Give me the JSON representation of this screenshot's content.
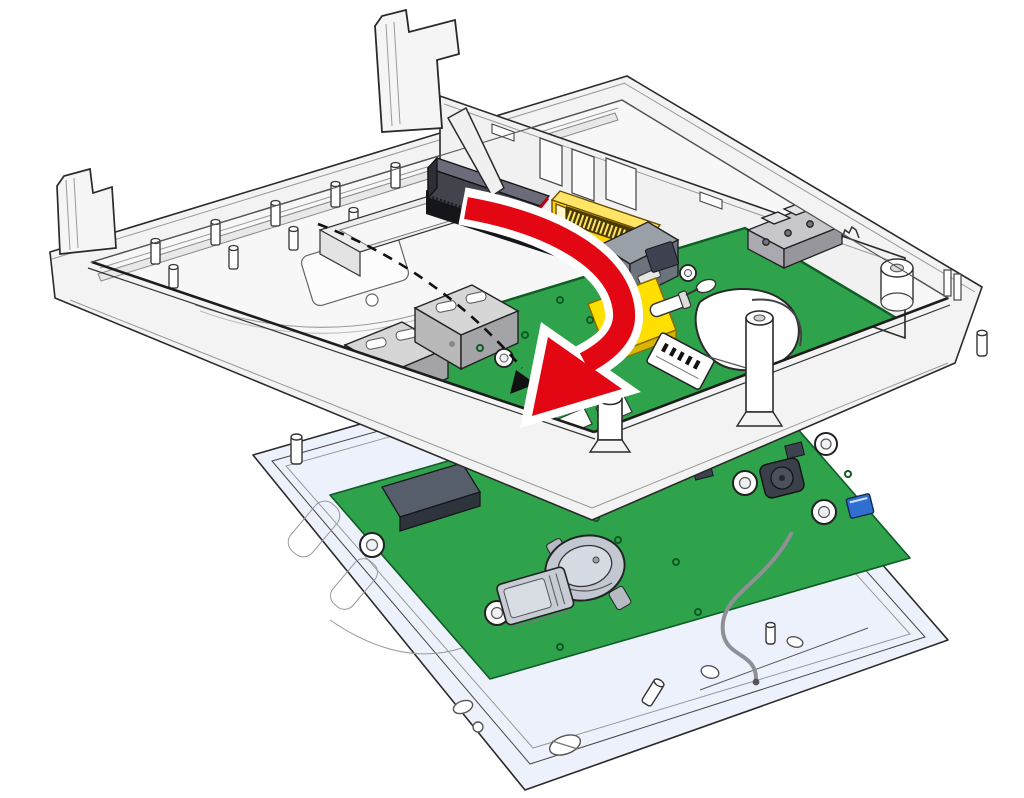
{
  "figure_type": "exploded-assembly-illustration",
  "colors": {
    "background": "#ffffff",
    "outline": "#2a2a2a",
    "case_fill": "#f3f3f3",
    "case_floor": "#f7f7f7",
    "tray_fill": "#edf1fb",
    "tray_inner": "#e6ebf9",
    "pcb_green": "#2fa24c",
    "pcb_green_dark": "#0f5c26",
    "arrow_red": "#e30613",
    "arrow_outline": "#ffffff",
    "connector_yellow": "#ffd200",
    "connector_yellow_light": "#ffe465",
    "pad_yellow": "#ffdf00",
    "connector_dark": "#43434e",
    "metal_gray": "#c9ccd3",
    "metal_gray_dark": "#9aa0aa",
    "component_blue": "#2f6fd0",
    "guide_dash": "#111111"
  },
  "parts": [
    {
      "name": "rear-housing",
      "desc": "white enclosure shell, open side up"
    },
    {
      "name": "housing-clip-large",
      "desc": "snap tab on rear edge"
    },
    {
      "name": "housing-clip-small",
      "desc": "snap tab on left corner"
    },
    {
      "name": "inner-bracket",
      "desc": "internal wall with cutouts"
    },
    {
      "name": "board-connector-dark",
      "desc": "board-to-board connector"
    },
    {
      "name": "board-connector-yellow",
      "desc": "yellow FFC edge connector"
    },
    {
      "name": "main-board",
      "desc": "green CPU board with connectors"
    },
    {
      "name": "ethernet-jacks",
      "desc": "two gray modular jacks"
    },
    {
      "name": "shielded-connector",
      "desc": "metal connector stack"
    },
    {
      "name": "terminal-block",
      "desc": "3-pole plug connector"
    },
    {
      "name": "yellow-pad",
      "desc": "yellow square pad"
    },
    {
      "name": "dip-switch",
      "desc": "white block with black marks"
    },
    {
      "name": "antenna-module",
      "desc": "white puck with wire"
    },
    {
      "name": "standoff-posts",
      "desc": "white cylindrical posts"
    },
    {
      "name": "io-board",
      "desc": "green I/O board on bezel"
    },
    {
      "name": "coin-cell-battery",
      "desc": "round backup battery in holder"
    },
    {
      "name": "microsd-slot",
      "desc": "memory card holder"
    },
    {
      "name": "buzzer",
      "desc": "dark round component"
    },
    {
      "name": "antenna-cable",
      "desc": "gray coax lead"
    },
    {
      "name": "front-bezel-tray",
      "desc": "light blue display tray"
    },
    {
      "name": "insertion-arrow",
      "desc": "red curved arrow showing board insertion"
    },
    {
      "name": "rotation-guide",
      "desc": "dashed arc with small arrowhead"
    }
  ]
}
